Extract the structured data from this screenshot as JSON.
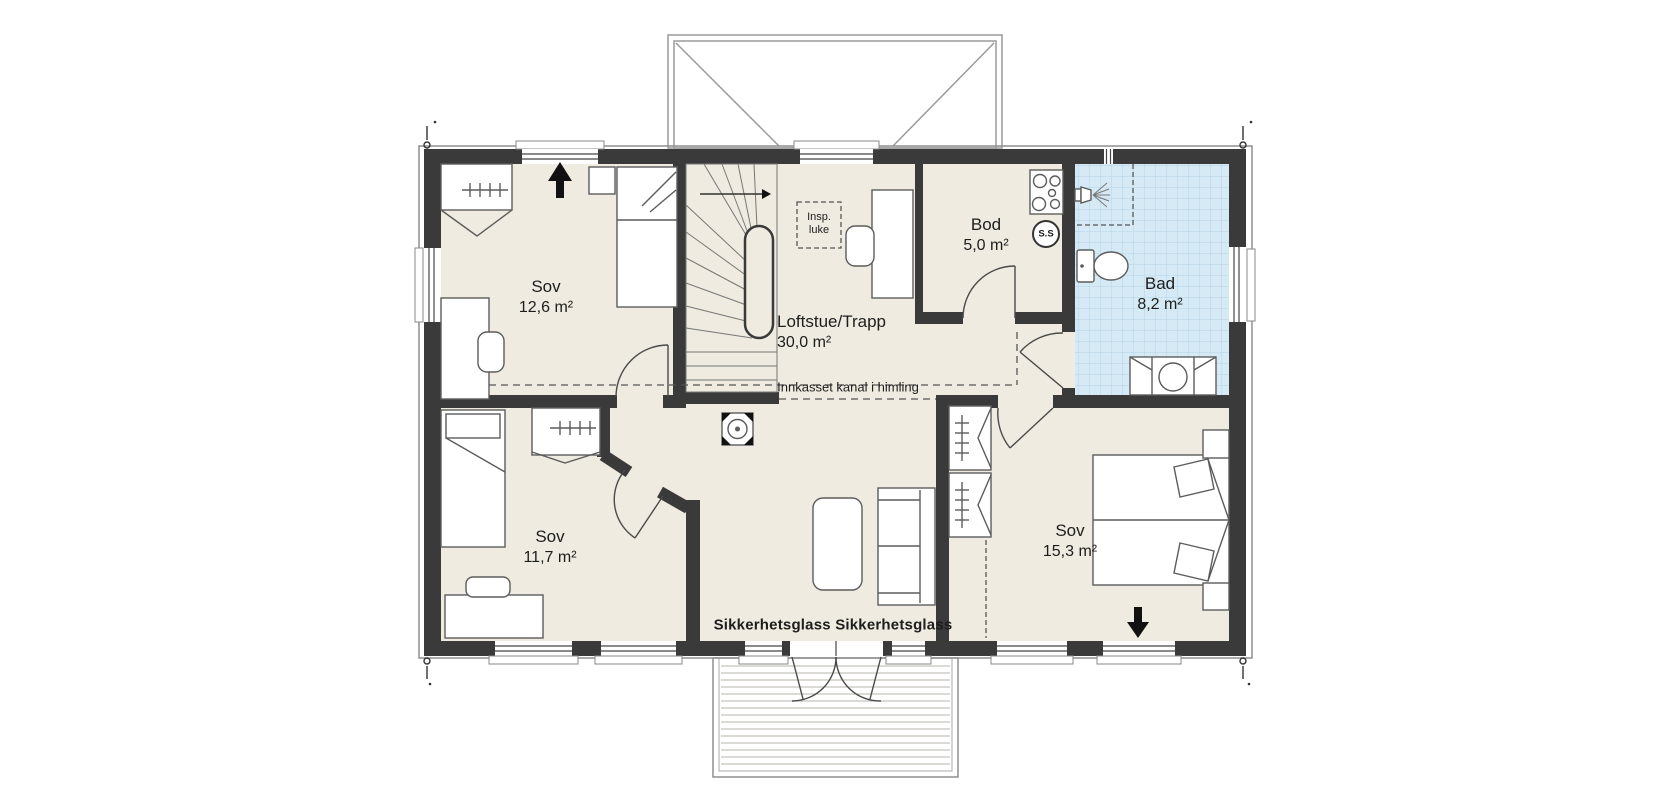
{
  "plan": {
    "type": "floor-plan",
    "floor": "loft"
  },
  "rooms": [
    {
      "name": "Sov",
      "area": "12,6 m²"
    },
    {
      "name": "Loftstue/Trapp",
      "area": "30,0 m²"
    },
    {
      "name": "Bod",
      "area": "5,0 m²"
    },
    {
      "name": "Bad",
      "area": "8,2 m²"
    },
    {
      "name": "Sov",
      "area": "11,7 m²"
    },
    {
      "name": "Sov",
      "area": "15,3 m²"
    }
  ],
  "annotations": {
    "duct_label": "Innkasset kanal i himling",
    "safety_glass_left": "Sikkerhetsglass",
    "safety_glass_right": "Sikkerhetsglass",
    "inspection_hatch_line1": "Insp.",
    "inspection_hatch_line2": "luke",
    "ss_badge": "S.S"
  },
  "colors": {
    "background": "#ffffff",
    "wall": "#3a3a3a",
    "floor": "#efebe0",
    "bathroom_tile": "#d6eaf5",
    "bathroom_grid": "#b6d4e6"
  }
}
